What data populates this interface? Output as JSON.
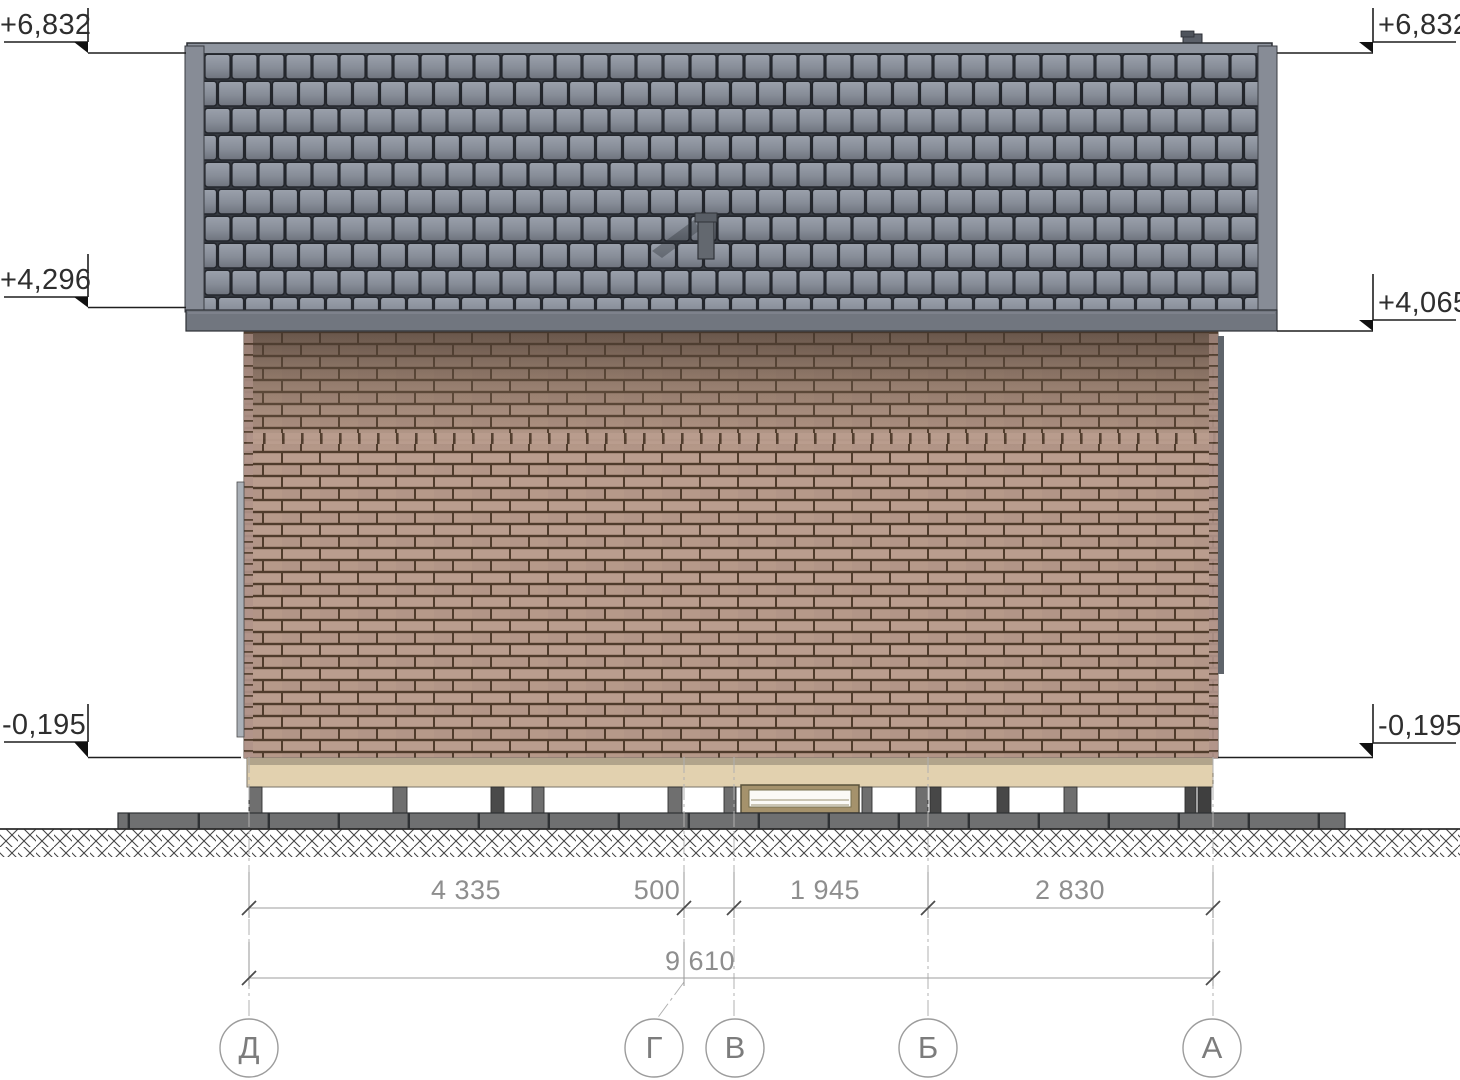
{
  "levels": {
    "top_left": "+6,832",
    "top_right": "+6,832",
    "mid_left": "+4,296",
    "mid_right": "+4,065",
    "bottom_left": "-0,195",
    "bottom_right": "-0,195"
  },
  "dimensions": {
    "segments": [
      "4 335",
      "500",
      "1 945",
      "2 830"
    ],
    "total": "9 610"
  },
  "axes": [
    "Д",
    "Г",
    "В",
    "Б",
    "А"
  ],
  "palette": {
    "roof_tile": "#8b919c",
    "roof_joint": "#363a41",
    "fascia": "#71767f",
    "barge_board": "#878c96",
    "brick_light": "#b89b8c",
    "brick_shaded_top": "#7e6a59",
    "mortar": "#503c2c",
    "plinth_beige": "#e2d1af",
    "plinth_top": "#b1a48b",
    "pile_gray": "#6f6f6f",
    "pile_dark": "#454545",
    "ground_beam": "#6f7071",
    "hatch_line": "#454545",
    "level_line": "#1f1f1f",
    "dim_line": "#9e9e9e",
    "dim_text": "#8e8e8e",
    "axis_text": "#7c7c7c"
  }
}
